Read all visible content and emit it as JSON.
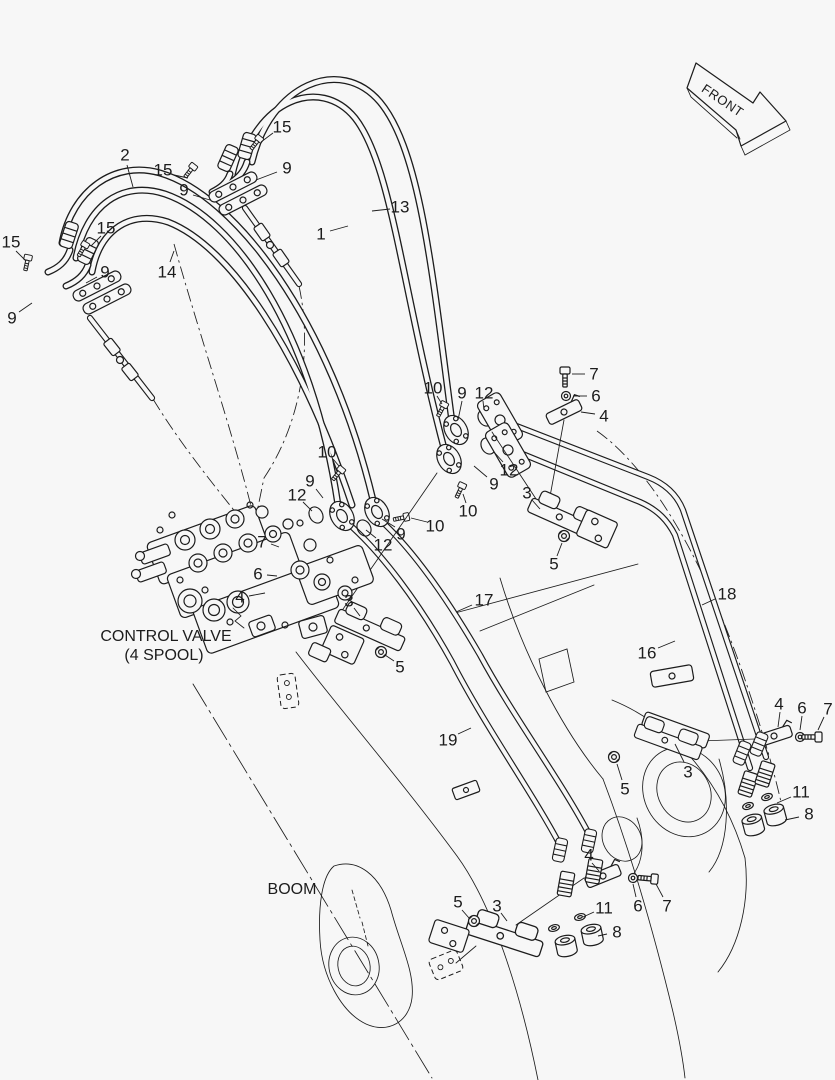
{
  "colors": {
    "background": "#f7f7f7",
    "ink": "#1c1c1c"
  },
  "front_arrow": {
    "label": "FRONT"
  },
  "annotations": {
    "control_valve_line1": "CONTROL VALVE",
    "control_valve_line2": "(4 SPOOL)",
    "boom": "BOOM"
  },
  "callouts": [
    {
      "t": "2",
      "tx": 125,
      "ty": 155,
      "x1": 127,
      "y1": 165,
      "x2": 133,
      "y2": 187
    },
    {
      "t": "15",
      "tx": 163,
      "ty": 170,
      "x1": 174,
      "y1": 175,
      "x2": 188,
      "y2": 178
    },
    {
      "t": "15",
      "tx": 282,
      "ty": 127,
      "x1": 273,
      "y1": 133,
      "x2": 261,
      "y2": 142
    },
    {
      "t": "9",
      "tx": 287,
      "ty": 168,
      "x1": 277,
      "y1": 172,
      "x2": 256,
      "y2": 180
    },
    {
      "t": "9",
      "tx": 184,
      "ty": 190,
      "x1": 193,
      "y1": 195,
      "x2": 210,
      "y2": 200
    },
    {
      "t": "13",
      "tx": 400,
      "ty": 207,
      "x1": 390,
      "y1": 209,
      "x2": 372,
      "y2": 211
    },
    {
      "t": "1",
      "tx": 321,
      "ty": 234,
      "x1": 330,
      "y1": 231,
      "x2": 348,
      "y2": 226
    },
    {
      "t": "15",
      "tx": 11,
      "ty": 242,
      "x1": 16,
      "y1": 251,
      "x2": 26,
      "y2": 261
    },
    {
      "t": "15",
      "tx": 106,
      "ty": 228,
      "x1": 101,
      "y1": 236,
      "x2": 91,
      "y2": 246
    },
    {
      "t": "9",
      "tx": 105,
      "ty": 272,
      "x1": 97,
      "y1": 277,
      "x2": 86,
      "y2": 283
    },
    {
      "t": "9",
      "tx": 12,
      "ty": 318,
      "x1": 19,
      "y1": 312,
      "x2": 32,
      "y2": 303
    },
    {
      "t": "14",
      "tx": 167,
      "ty": 272,
      "x1": 170,
      "y1": 262,
      "x2": 174,
      "y2": 251
    },
    {
      "t": "10",
      "tx": 433,
      "ty": 388,
      "x1": 437,
      "y1": 396,
      "x2": 442,
      "y2": 404
    },
    {
      "t": "9",
      "tx": 462,
      "ty": 393,
      "x1": 462,
      "y1": 401,
      "x2": 458,
      "y2": 420
    },
    {
      "t": "12",
      "tx": 484,
      "ty": 393,
      "x1": 483,
      "y1": 401,
      "x2": 484,
      "y2": 410
    },
    {
      "t": "7",
      "tx": 594,
      "ty": 374,
      "x1": 585,
      "y1": 374,
      "x2": 572,
      "y2": 374
    },
    {
      "t": "6",
      "tx": 596,
      "ty": 396,
      "x1": 587,
      "y1": 396,
      "x2": 573,
      "y2": 396
    },
    {
      "t": "4",
      "tx": 604,
      "ty": 416,
      "x1": 595,
      "y1": 414,
      "x2": 581,
      "y2": 412
    },
    {
      "t": "12",
      "tx": 509,
      "ty": 470,
      "x1": 503,
      "y1": 462,
      "x2": 494,
      "y2": 452
    },
    {
      "t": "9",
      "tx": 494,
      "ty": 484,
      "x1": 487,
      "y1": 477,
      "x2": 474,
      "y2": 466
    },
    {
      "t": "10",
      "tx": 327,
      "ty": 452,
      "x1": 333,
      "y1": 459,
      "x2": 339,
      "y2": 466
    },
    {
      "t": "9",
      "tx": 310,
      "ty": 481,
      "x1": 316,
      "y1": 489,
      "x2": 323,
      "y2": 498
    },
    {
      "t": "12",
      "tx": 297,
      "ty": 495,
      "x1": 303,
      "y1": 502,
      "x2": 312,
      "y2": 511
    },
    {
      "t": "10",
      "tx": 468,
      "ty": 511,
      "x1": 466,
      "y1": 503,
      "x2": 463,
      "y2": 494
    },
    {
      "t": "10",
      "tx": 435,
      "ty": 526,
      "x1": 427,
      "y1": 522,
      "x2": 411,
      "y2": 518
    },
    {
      "t": "9",
      "tx": 401,
      "ty": 534,
      "x1": 395,
      "y1": 527,
      "x2": 382,
      "y2": 519
    },
    {
      "t": "12",
      "tx": 383,
      "ty": 545,
      "x1": 376,
      "y1": 538,
      "x2": 366,
      "y2": 530
    },
    {
      "t": "3",
      "tx": 527,
      "ty": 493,
      "x1": 532,
      "y1": 500,
      "x2": 540,
      "y2": 509
    },
    {
      "t": "5",
      "tx": 554,
      "ty": 564,
      "x1": 557,
      "y1": 556,
      "x2": 562,
      "y2": 543
    },
    {
      "t": "7",
      "tx": 262,
      "ty": 542,
      "x1": 271,
      "y1": 544,
      "x2": 279,
      "y2": 547
    },
    {
      "t": "6",
      "tx": 258,
      "ty": 574,
      "x1": 267,
      "y1": 575,
      "x2": 277,
      "y2": 576
    },
    {
      "t": "4",
      "tx": 240,
      "ty": 597,
      "x1": 249,
      "y1": 596,
      "x2": 265,
      "y2": 593
    },
    {
      "t": "3",
      "tx": 349,
      "ty": 601,
      "x1": 354,
      "y1": 608,
      "x2": 360,
      "y2": 616
    },
    {
      "t": "5",
      "tx": 400,
      "ty": 667,
      "x1": 394,
      "y1": 661,
      "x2": 385,
      "y2": 655
    },
    {
      "t": "17",
      "tx": 484,
      "ty": 600,
      "x1": 472,
      "y1": 605,
      "x2": 456,
      "y2": 612
    },
    {
      "t": "18",
      "tx": 727,
      "ty": 594,
      "x1": 715,
      "y1": 599,
      "x2": 702,
      "y2": 605
    },
    {
      "t": "16",
      "tx": 647,
      "ty": 653,
      "x1": 658,
      "y1": 648,
      "x2": 675,
      "y2": 641
    },
    {
      "t": "19",
      "tx": 448,
      "ty": 740,
      "x1": 458,
      "y1": 734,
      "x2": 471,
      "y2": 728
    },
    {
      "t": "3",
      "tx": 688,
      "ty": 772,
      "x1": 684,
      "y1": 762,
      "x2": 675,
      "y2": 744
    },
    {
      "t": "5",
      "tx": 625,
      "ty": 789,
      "x1": 622,
      "y1": 780,
      "x2": 617,
      "y2": 764
    },
    {
      "t": "4",
      "tx": 779,
      "ty": 704,
      "x1": 780,
      "y1": 712,
      "x2": 778,
      "y2": 727
    },
    {
      "t": "6",
      "tx": 802,
      "ty": 708,
      "x1": 802,
      "y1": 716,
      "x2": 800,
      "y2": 730
    },
    {
      "t": "7",
      "tx": 828,
      "ty": 709,
      "x1": 824,
      "y1": 717,
      "x2": 818,
      "y2": 730
    },
    {
      "t": "11",
      "tx": 801,
      "ty": 792,
      "x1": 791,
      "y1": 797,
      "x2": 777,
      "y2": 803
    },
    {
      "t": "8",
      "tx": 809,
      "ty": 814,
      "x1": 799,
      "y1": 817,
      "x2": 785,
      "y2": 820
    },
    {
      "t": "4",
      "tx": 589,
      "ty": 855,
      "x1": 592,
      "y1": 863,
      "x2": 599,
      "y2": 871
    },
    {
      "t": "6",
      "tx": 638,
      "ty": 906,
      "x1": 636,
      "y1": 897,
      "x2": 633,
      "y2": 884
    },
    {
      "t": "7",
      "tx": 667,
      "ty": 906,
      "x1": 663,
      "y1": 897,
      "x2": 656,
      "y2": 884
    },
    {
      "t": "11",
      "tx": 604,
      "ty": 908,
      "x1": 594,
      "y1": 912,
      "x2": 583,
      "y2": 917
    },
    {
      "t": "8",
      "tx": 617,
      "ty": 932,
      "x1": 607,
      "y1": 934,
      "x2": 598,
      "y2": 936
    },
    {
      "t": "5",
      "tx": 458,
      "ty": 902,
      "x1": 462,
      "y1": 910,
      "x2": 469,
      "y2": 918
    },
    {
      "t": "3",
      "tx": 497,
      "ty": 906,
      "x1": 501,
      "y1": 913,
      "x2": 507,
      "y2": 921
    }
  ]
}
